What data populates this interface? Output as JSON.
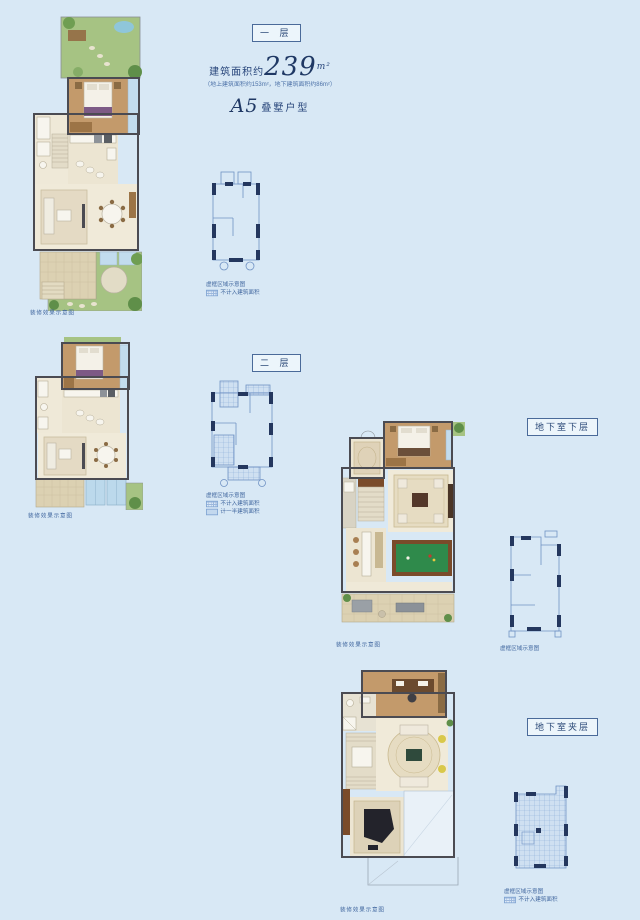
{
  "colors": {
    "background": "#d8e8f5",
    "accent_navy": "#1f3864",
    "schematic_line": "#7092c4",
    "plan_wall": "#4b4b52",
    "garden_green": "#a6c383",
    "pool_table_green": "#2f8a4b"
  },
  "header": {
    "area_prefix": "建筑面积约",
    "area_value": "239",
    "area_unit": "m²",
    "area_note": "（地上建筑面积约153m²，地下建筑面积约86m²）",
    "model": "A5",
    "model_suffix": "叠墅户型"
  },
  "labels": {
    "floor1": "一 层",
    "floor2": "二 层",
    "basement_lower": "地下室下层",
    "basement_mezzanine": "地下室夹层"
  },
  "captions": {
    "plan1": "装修效果示意图",
    "plan2": "装修效果示意图",
    "plan_b1": "装修效果示意图",
    "plan_b2": "装修效果示意图"
  },
  "legend": {
    "outline": "虚框区域示意图",
    "not_counted": "不计入建筑面积",
    "half_counted": "计一半建筑面积"
  }
}
